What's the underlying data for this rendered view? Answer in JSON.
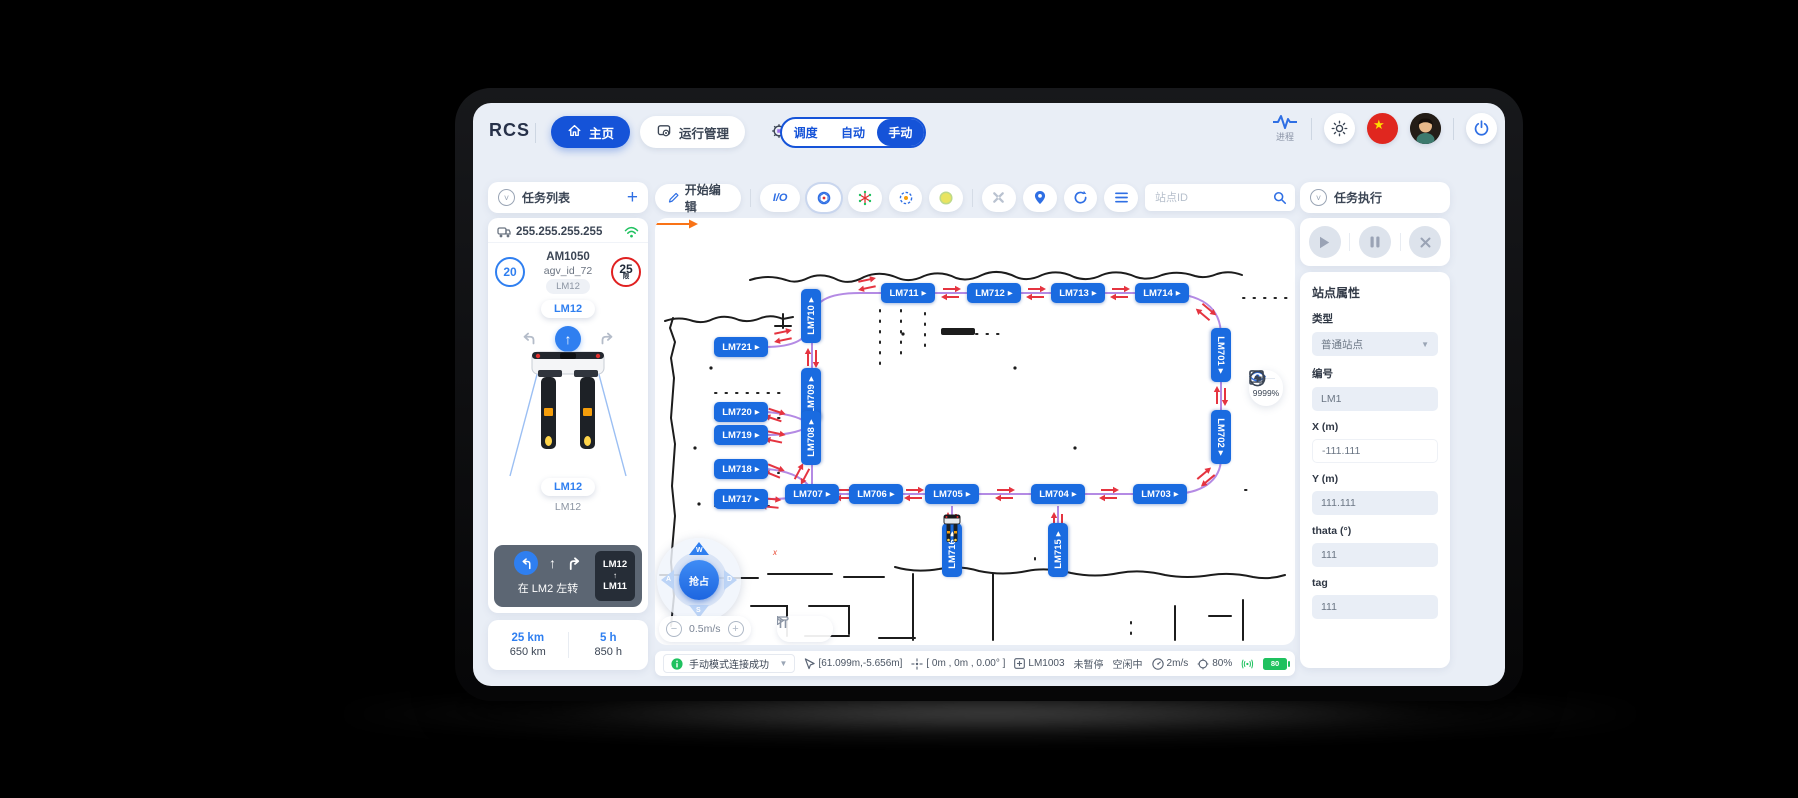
{
  "colors": {
    "accent": "#1553d8",
    "station": "#1a6be0",
    "route": "#b48ae4",
    "arrow": "#e53440",
    "green": "#1fc15f",
    "danger": "#e02020"
  },
  "header": {
    "logo": "RCS",
    "nav": [
      {
        "label": "主页"
      },
      {
        "label": "运行管理"
      },
      {
        "label": "设备管理"
      }
    ],
    "mode_toggle": {
      "options": [
        "调度",
        "自动",
        "手动"
      ],
      "active": "手动"
    },
    "process_label": "进程"
  },
  "sidebar": {
    "title": "任务列表",
    "add_label": "+",
    "agv_card": {
      "ip": "255.255.255.255",
      "left_badge": "20",
      "model": "AM1050",
      "agv_id": "agv_id_72",
      "station_chip": "LM12",
      "speed_limit": "25",
      "speed_limit_sub": "限",
      "pill_top": "LM12",
      "pill_bottom": "LM12",
      "sub_label": "LM12"
    },
    "nav_panel": {
      "instruction": "在 LM2 左转",
      "route_from": "LM12",
      "route_arrow": "↑",
      "route_to": "LM11"
    },
    "stats": [
      {
        "value": "25 km",
        "total": "650 km"
      },
      {
        "value": "5 h",
        "total": "850 h"
      }
    ]
  },
  "map": {
    "toolbar": {
      "edit_label": "开始编辑",
      "io_label": "I/O",
      "search_placeholder": "站点ID"
    },
    "joystick": {
      "center": "抢占",
      "up": "W",
      "left": "A",
      "right": "D",
      "down": "S"
    },
    "speed_value": "0.5m/s",
    "minus_glyph": "−",
    "plus_glyph": "+",
    "zoom_percent": "9999%",
    "axis_label": "x",
    "station_arrow": "▶",
    "stations": [
      {
        "id": "LM711",
        "x": 253,
        "y": 75,
        "o": "h"
      },
      {
        "id": "LM712",
        "x": 339,
        "y": 75,
        "o": "h"
      },
      {
        "id": "LM713",
        "x": 423,
        "y": 75,
        "o": "h"
      },
      {
        "id": "LM714",
        "x": 507,
        "y": 75,
        "o": "h"
      },
      {
        "id": "LM710",
        "x": 156,
        "y": 98,
        "o": "v",
        "dir": "up"
      },
      {
        "id": "LM721",
        "x": 86,
        "y": 129,
        "o": "h"
      },
      {
        "id": "LM701",
        "x": 566,
        "y": 137,
        "o": "v",
        "dir": "down"
      },
      {
        "id": "LM709",
        "x": 156,
        "y": 177,
        "o": "v",
        "dir": "up"
      },
      {
        "id": "LM720",
        "x": 86,
        "y": 194,
        "o": "h"
      },
      {
        "id": "LM719",
        "x": 86,
        "y": 217,
        "o": "h"
      },
      {
        "id": "LM708",
        "x": 156,
        "y": 220,
        "o": "v",
        "dir": "up"
      },
      {
        "id": "LM702",
        "x": 566,
        "y": 219,
        "o": "v",
        "dir": "down"
      },
      {
        "id": "LM718",
        "x": 86,
        "y": 251,
        "o": "h"
      },
      {
        "id": "LM717",
        "x": 86,
        "y": 281,
        "o": "h"
      },
      {
        "id": "LM707",
        "x": 157,
        "y": 276,
        "o": "h"
      },
      {
        "id": "LM706",
        "x": 221,
        "y": 276,
        "o": "h"
      },
      {
        "id": "LM705",
        "x": 297,
        "y": 276,
        "o": "h"
      },
      {
        "id": "LM704",
        "x": 403,
        "y": 276,
        "o": "h"
      },
      {
        "id": "LM703",
        "x": 505,
        "y": 276,
        "o": "h"
      },
      {
        "id": "LM716",
        "x": 297,
        "y": 332,
        "o": "v",
        "dir": "up"
      },
      {
        "id": "LM715",
        "x": 403,
        "y": 332,
        "o": "v",
        "dir": "up"
      }
    ],
    "edges": [
      {
        "d": "M 205,75 L 507,75"
      },
      {
        "d": "M 507,75 C 548,75 566,90 566,118"
      },
      {
        "d": "M 566,110 L 566,245"
      },
      {
        "d": "M 566,240 C 566,263 546,276 516,276"
      },
      {
        "d": "M 520,276 L 140,276"
      },
      {
        "d": "M 157,276 L 157,98"
      },
      {
        "d": "M 157,104 C 157,83 173,75 205,75"
      },
      {
        "d": "M 110,129 C 140,129 152,121 156,107"
      },
      {
        "d": "M 112,194 C 136,196 150,201 155,208"
      },
      {
        "d": "M 112,217 C 136,217 149,212 155,207"
      },
      {
        "d": "M 112,251 C 136,253 148,261 154,268"
      },
      {
        "d": "M 112,281 C 132,281 146,279 154,277"
      },
      {
        "d": "M 297,288 L 297,320"
      },
      {
        "d": "M 403,288 L 403,320"
      }
    ],
    "arrow_pairs": [
      {
        "x": 212,
        "y": 66,
        "a": -12
      },
      {
        "x": 296,
        "y": 75,
        "a": 0
      },
      {
        "x": 381,
        "y": 75,
        "a": 0
      },
      {
        "x": 465,
        "y": 75,
        "a": 0
      },
      {
        "x": 551,
        "y": 94,
        "a": 40
      },
      {
        "x": 566,
        "y": 178,
        "a": 90
      },
      {
        "x": 551,
        "y": 259,
        "a": 140
      },
      {
        "x": 190,
        "y": 276,
        "a": 0
      },
      {
        "x": 259,
        "y": 276,
        "a": 0
      },
      {
        "x": 350,
        "y": 276,
        "a": 0
      },
      {
        "x": 454,
        "y": 276,
        "a": 0
      },
      {
        "x": 147,
        "y": 256,
        "a": -62
      },
      {
        "x": 157,
        "y": 140,
        "a": 90
      },
      {
        "x": 128,
        "y": 118,
        "a": -12
      },
      {
        "x": 120,
        "y": 197,
        "a": 18
      },
      {
        "x": 120,
        "y": 219,
        "a": 12
      },
      {
        "x": 119,
        "y": 253,
        "a": 22
      },
      {
        "x": 116,
        "y": 285,
        "a": 6
      },
      {
        "x": 297,
        "y": 304,
        "a": 90
      },
      {
        "x": 403,
        "y": 304,
        "a": 90
      }
    ],
    "status_bar": {
      "message": "手动模式连接成功",
      "cursor_pos": "[61.099m,-5.656m]",
      "robot_pose": "[ 0m , 0m , 0.00° ]",
      "station": "LM1003",
      "pause_state": "未暂停",
      "idle_state": "空闲中",
      "speed": "2m/s",
      "percent": "80%",
      "battery": "80"
    }
  },
  "right_panel": {
    "title": "任务执行",
    "properties_title": "站点属性",
    "fields": [
      {
        "label": "类型",
        "value": "普通站点",
        "type": "select"
      },
      {
        "label": "编号",
        "value": "LM1"
      },
      {
        "label": "X (m)",
        "value": "-111.111",
        "plain": true
      },
      {
        "label": "Y (m)",
        "value": "111.111"
      },
      {
        "label": "thata (°)",
        "value": "111"
      },
      {
        "label": "tag",
        "value": "111"
      }
    ]
  }
}
